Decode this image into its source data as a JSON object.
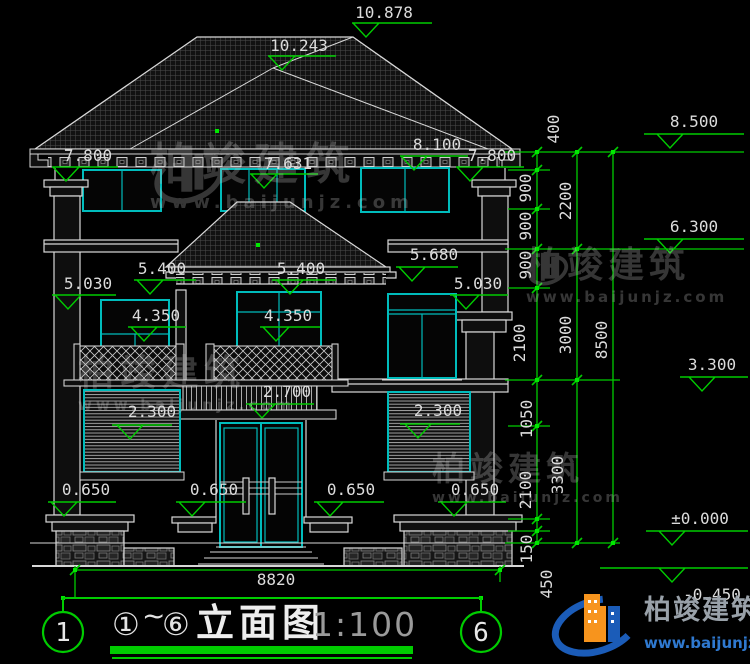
{
  "title": {
    "circled_start": "①",
    "tilde": "~",
    "circled_end": "⑥",
    "text": "立面图",
    "scale": "1:100"
  },
  "axis_bubbles": {
    "left": "1",
    "right": "6"
  },
  "watermark": {
    "brand": "柏竣建筑",
    "url": "www.baijunjz.com"
  },
  "logo": {
    "brand": "柏竣建筑",
    "url": "www.baijunjz.com"
  },
  "colors": {
    "background": "#000000",
    "linework_white": "#d8d8d8",
    "window_cyan": "#00bcbc",
    "dimension_green": "#00cc00",
    "logo_blue": "#2b6fc2",
    "logo_orange": "#f7941d"
  },
  "elevation_labels": [
    {
      "text": "10.878",
      "x": 384,
      "y": 5
    },
    {
      "text": "10.243",
      "x": 299,
      "y": 38
    },
    {
      "text": "8.100",
      "x": 437,
      "y": 137
    },
    {
      "text": "7.800",
      "x": 88,
      "y": 148
    },
    {
      "text": "7.631",
      "x": 288,
      "y": 156
    },
    {
      "text": "7.800",
      "x": 492,
      "y": 148
    },
    {
      "text": "8.500",
      "x": 694,
      "y": 114
    },
    {
      "text": "6.300",
      "x": 694,
      "y": 219
    },
    {
      "text": "5.680",
      "x": 434,
      "y": 247
    },
    {
      "text": "5.400",
      "x": 162,
      "y": 261
    },
    {
      "text": "5.400",
      "x": 301,
      "y": 261
    },
    {
      "text": "5.030",
      "x": 88,
      "y": 276
    },
    {
      "text": "5.030",
      "x": 478,
      "y": 276
    },
    {
      "text": "4.350",
      "x": 156,
      "y": 308
    },
    {
      "text": "4.350",
      "x": 288,
      "y": 308
    },
    {
      "text": "3.300",
      "x": 712,
      "y": 357
    },
    {
      "text": "2.700",
      "x": 287,
      "y": 384
    },
    {
      "text": "2.300",
      "x": 152,
      "y": 404
    },
    {
      "text": "2.300",
      "x": 438,
      "y": 403
    },
    {
      "text": "0.650",
      "x": 86,
      "y": 482
    },
    {
      "text": "0.650",
      "x": 214,
      "y": 482
    },
    {
      "text": "0.650",
      "x": 351,
      "y": 482
    },
    {
      "text": "0.650",
      "x": 475,
      "y": 482
    },
    {
      "text": "±0.000",
      "x": 700,
      "y": 511
    },
    {
      "text": "-0.450",
      "x": 712,
      "y": 587
    },
    {
      "text": "8820",
      "x": 276,
      "y": 572
    }
  ],
  "chain_labels": [
    {
      "text": "400",
      "x": 554,
      "y": 129
    },
    {
      "text": "900",
      "x": 526,
      "y": 188
    },
    {
      "text": "900",
      "x": 526,
      "y": 226
    },
    {
      "text": "900",
      "x": 526,
      "y": 265
    },
    {
      "text": "2200",
      "x": 566,
      "y": 201
    },
    {
      "text": "2100",
      "x": 520,
      "y": 343
    },
    {
      "text": "3000",
      "x": 566,
      "y": 335
    },
    {
      "text": "8500",
      "x": 602,
      "y": 340
    },
    {
      "text": "1050",
      "x": 527,
      "y": 419
    },
    {
      "text": "3300",
      "x": 558,
      "y": 475
    },
    {
      "text": "2100",
      "x": 526,
      "y": 490
    },
    {
      "text": "150",
      "x": 527,
      "y": 549
    },
    {
      "text": "450",
      "x": 547,
      "y": 584
    }
  ]
}
